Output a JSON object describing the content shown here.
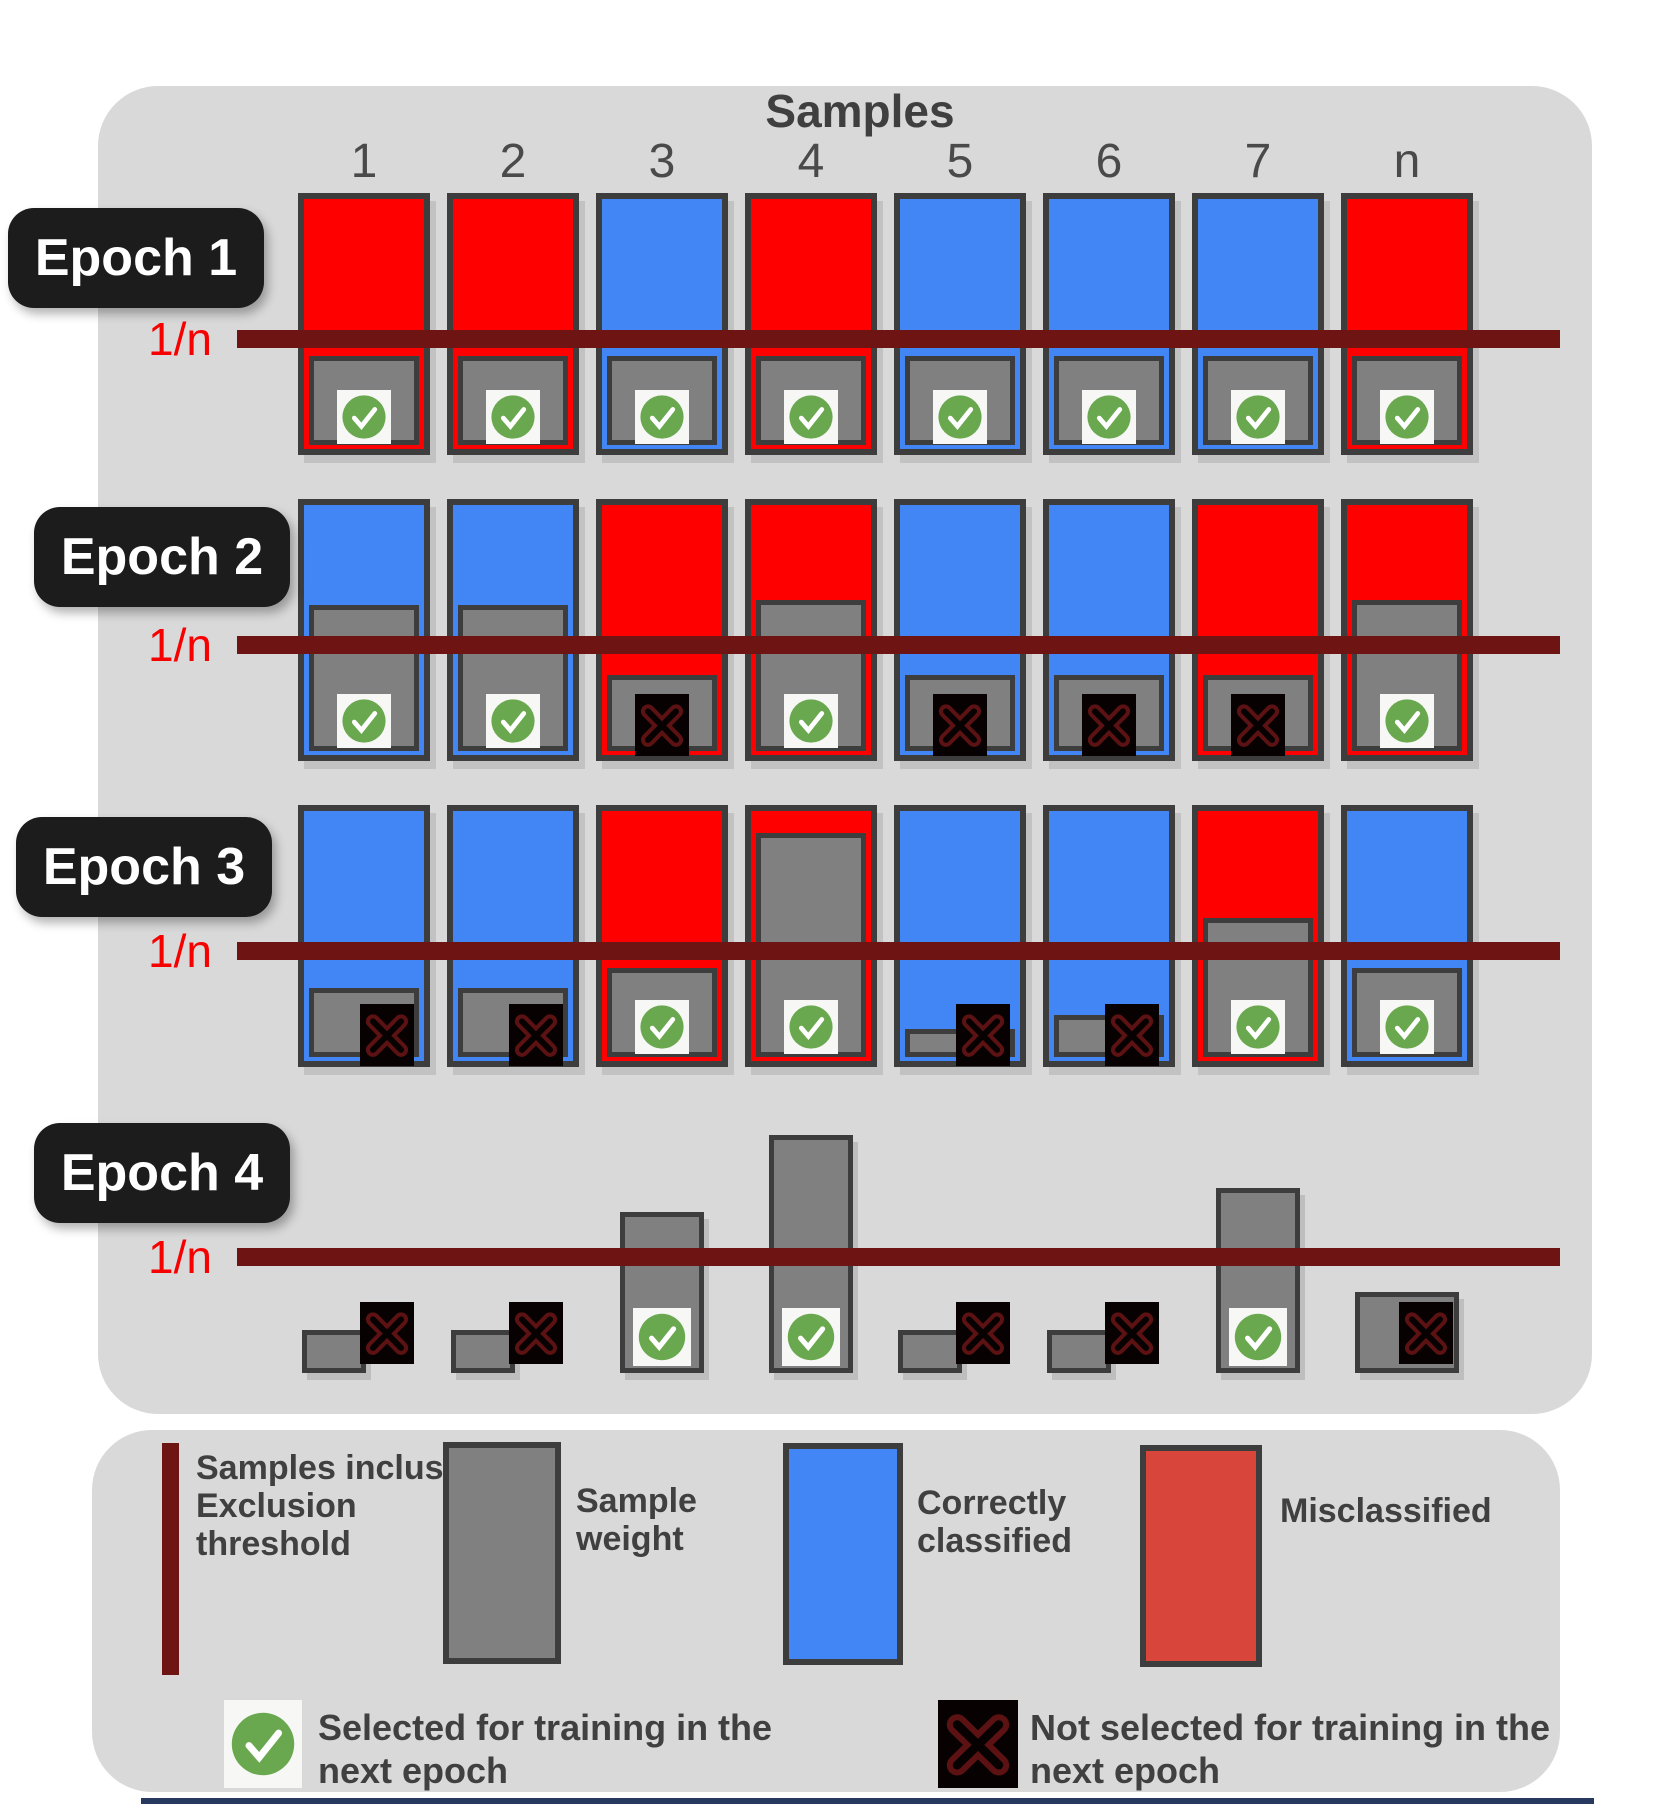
{
  "title": "Samples",
  "columns": [
    "1",
    "2",
    "3",
    "4",
    "5",
    "6",
    "7",
    "n"
  ],
  "threshold_label": "1/n",
  "colors": {
    "misclassified_red": "#fe0000",
    "correct_blue": "#4285f4",
    "legend_red": "#d8453a",
    "weight_gray": "#808080",
    "outline": "#3d3d3d",
    "threshold_line": "#6e1413",
    "threshold_text": "#f60000",
    "panel_bg": "#d9d9d9",
    "epoch_label_bg": "#1c1c1c",
    "check_green": "#6aa84f",
    "icon_square_white": "#f7f7f5",
    "x_square_black": "#070102",
    "x_stroke_dark_red": "#5c1212",
    "bottom_strip_blue": "#27395f"
  },
  "epochs": [
    {
      "label": "Epoch 1",
      "samples": [
        {
          "col": "1",
          "status": "misclassified",
          "weight_h": 89,
          "selected": true,
          "icon_pos": "center"
        },
        {
          "col": "2",
          "status": "misclassified",
          "weight_h": 89,
          "selected": true,
          "icon_pos": "center"
        },
        {
          "col": "3",
          "status": "correct",
          "weight_h": 89,
          "selected": true,
          "icon_pos": "center"
        },
        {
          "col": "4",
          "status": "misclassified",
          "weight_h": 89,
          "selected": true,
          "icon_pos": "center"
        },
        {
          "col": "5",
          "status": "correct",
          "weight_h": 89,
          "selected": true,
          "icon_pos": "center"
        },
        {
          "col": "6",
          "status": "correct",
          "weight_h": 89,
          "selected": true,
          "icon_pos": "center"
        },
        {
          "col": "7",
          "status": "correct",
          "weight_h": 89,
          "selected": true,
          "icon_pos": "center"
        },
        {
          "col": "n",
          "status": "misclassified",
          "weight_h": 89,
          "selected": true,
          "icon_pos": "center"
        }
      ]
    },
    {
      "label": "Epoch 2",
      "samples": [
        {
          "col": "1",
          "status": "correct",
          "weight_h": 146,
          "selected": true,
          "icon_pos": "center"
        },
        {
          "col": "2",
          "status": "correct",
          "weight_h": 146,
          "selected": true,
          "icon_pos": "center"
        },
        {
          "col": "3",
          "status": "misclassified",
          "weight_h": 76,
          "selected": false,
          "icon_pos": "center"
        },
        {
          "col": "4",
          "status": "misclassified",
          "weight_h": 151,
          "selected": true,
          "icon_pos": "center"
        },
        {
          "col": "5",
          "status": "correct",
          "weight_h": 76,
          "selected": false,
          "icon_pos": "center"
        },
        {
          "col": "6",
          "status": "correct",
          "weight_h": 76,
          "selected": false,
          "icon_pos": "center"
        },
        {
          "col": "7",
          "status": "misclassified",
          "weight_h": 76,
          "selected": false,
          "icon_pos": "center"
        },
        {
          "col": "n",
          "status": "misclassified",
          "weight_h": 151,
          "selected": true,
          "icon_pos": "center"
        }
      ]
    },
    {
      "label": "Epoch 3",
      "samples": [
        {
          "col": "1",
          "status": "correct",
          "weight_h": 69,
          "selected": false,
          "icon_pos": "right"
        },
        {
          "col": "2",
          "status": "correct",
          "weight_h": 69,
          "selected": false,
          "icon_pos": "right"
        },
        {
          "col": "3",
          "status": "misclassified",
          "weight_h": 89,
          "selected": true,
          "icon_pos": "center"
        },
        {
          "col": "4",
          "status": "misclassified",
          "weight_h": 224,
          "selected": true,
          "icon_pos": "center"
        },
        {
          "col": "5",
          "status": "correct",
          "weight_h": 28,
          "selected": false,
          "icon_pos": "right"
        },
        {
          "col": "6",
          "status": "correct",
          "weight_h": 42,
          "selected": false,
          "icon_pos": "right"
        },
        {
          "col": "7",
          "status": "misclassified",
          "weight_h": 139,
          "selected": true,
          "icon_pos": "center"
        },
        {
          "col": "n",
          "status": "correct",
          "weight_h": 89,
          "selected": true,
          "icon_pos": "center"
        }
      ]
    },
    {
      "label": "Epoch 4",
      "samples": [
        {
          "col": "1",
          "status": "none",
          "weight_h": 43,
          "weight_w": 64,
          "selected": false,
          "icon_pos": "right"
        },
        {
          "col": "2",
          "status": "none",
          "weight_h": 43,
          "weight_w": 64,
          "selected": false,
          "icon_pos": "right"
        },
        {
          "col": "3",
          "status": "none",
          "weight_h": 161,
          "weight_w": 84,
          "selected": true,
          "icon_pos": "center"
        },
        {
          "col": "4",
          "status": "none",
          "weight_h": 238,
          "weight_w": 84,
          "selected": true,
          "icon_pos": "center"
        },
        {
          "col": "5",
          "status": "none",
          "weight_h": 43,
          "weight_w": 64,
          "selected": false,
          "icon_pos": "right"
        },
        {
          "col": "6",
          "status": "none",
          "weight_h": 43,
          "weight_w": 64,
          "selected": false,
          "icon_pos": "right"
        },
        {
          "col": "7",
          "status": "none",
          "weight_h": 185,
          "weight_w": 84,
          "selected": true,
          "icon_pos": "center"
        },
        {
          "col": "n",
          "status": "none",
          "weight_h": 81,
          "weight_w": 104,
          "selected": false,
          "icon_pos": "inside-right"
        }
      ]
    }
  ],
  "legend": {
    "threshold": {
      "label": "Samples inclus\nExclusion\nthreshold"
    },
    "weight": {
      "label": "Sample\nweight"
    },
    "correct": {
      "label": "Correctly\nclassified"
    },
    "misclassified": {
      "label": "Misclassified"
    },
    "selected": {
      "label": "Selected for training in the\nnext epoch"
    },
    "not_selected": {
      "label": "Not selected for training in the\nnext epoch"
    }
  }
}
